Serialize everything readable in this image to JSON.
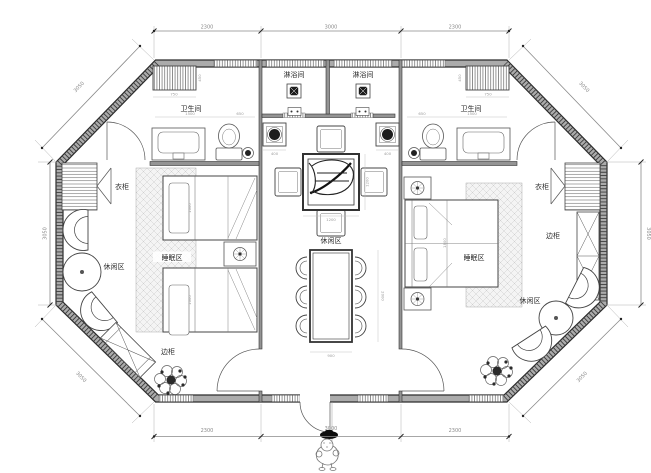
{
  "meta": {
    "drawing_type": "floor-plan",
    "shape": "octagonal cabin, two guest rooms with shared central lounge"
  },
  "labels": {
    "shower_left": "淋浴间",
    "shower_right": "淋浴间",
    "bathroom_left": "卫生间",
    "bathroom_right": "卫生间",
    "wardrobe_left": "衣柜",
    "wardrobe_right": "衣柜",
    "cabinet_left": "边柜",
    "cabinet_right": "边柜",
    "sleeping_left": "睡眠区",
    "sleeping_right": "睡眠区",
    "leisure_left": "休闲区",
    "leisure_center": "休闲区",
    "leisure_right": "休闲区"
  },
  "dims": {
    "top": [
      "2300",
      "3000",
      "2300"
    ],
    "bottom": [
      "2300",
      "3000",
      "2300"
    ],
    "left": "3050",
    "right": "3050",
    "diag": "3050"
  },
  "sd": {
    "radiator": "750",
    "bath_main": "1500",
    "bath_rest": "650",
    "basin": "400",
    "tea_table": "1200",
    "dining_width": "900",
    "dining_length": "2000",
    "twin_bed": "1000",
    "double_bed": "1800",
    "radiator_depth": "450"
  },
  "colors": {
    "wall_edge": "#2c2c2c",
    "wall_fill": "#ababab",
    "dim_line": "#8a8a8a",
    "label_text": "#2a2a2a",
    "carpet": "#f4f4f4"
  }
}
